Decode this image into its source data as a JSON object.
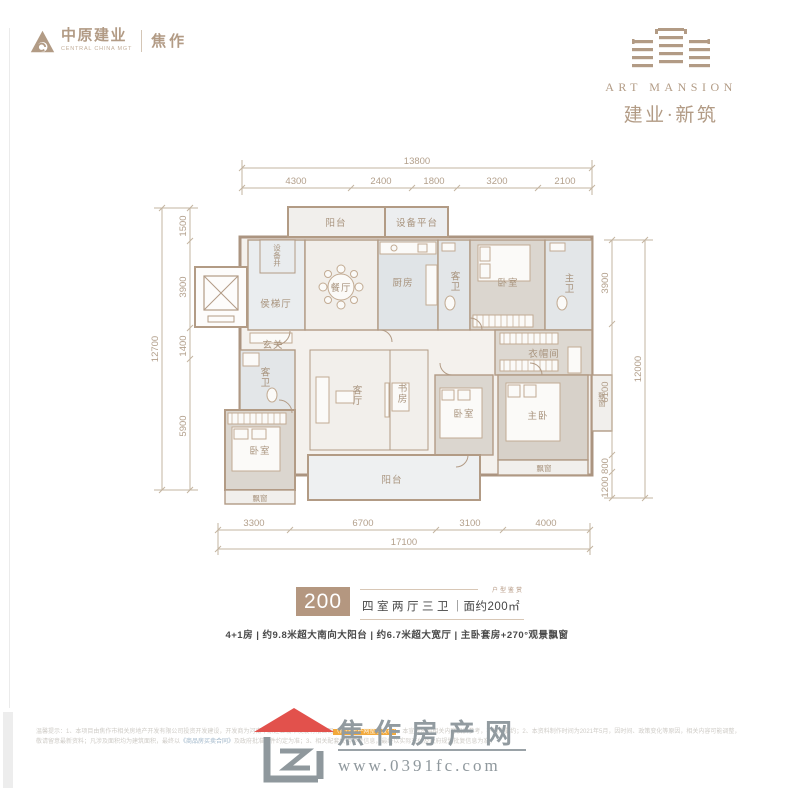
{
  "header": {
    "brand_cn": "中原建业",
    "brand_en": "CENTRAL CHINA MGT",
    "city": "焦作",
    "project_en": "ART MANSION",
    "project_cn": "建业·新筑"
  },
  "floorplan": {
    "dims_top": {
      "total": "13800",
      "segments": [
        "4300",
        "2400",
        "1800",
        "3200",
        "2100"
      ]
    },
    "dims_left": {
      "total": "12700",
      "segments": [
        "1500",
        "3900",
        "1400",
        "5900"
      ]
    },
    "dims_right": {
      "total": "12000",
      "segments": [
        "3900",
        "6100",
        "800",
        "1200"
      ]
    },
    "dims_bottom": {
      "total": "17100",
      "segments": [
        "3300",
        "6700",
        "3100",
        "4000"
      ]
    },
    "rooms": {
      "balcony_top": "阳台",
      "equipment_platform": "设备平台",
      "equipment_shaft": "设备井",
      "elevator_hall": "侯梯厅",
      "dining": "餐厅",
      "kitchen": "厨房",
      "guest_bath_top": "客卫",
      "bedroom_top": "卧室",
      "master_bath": "主卫",
      "foyer": "玄关",
      "cloakroom": "衣帽间",
      "guest_bath_left": "客卫",
      "bedroom_left": "卧室",
      "living": "客厅",
      "study": "书房",
      "bedroom_mid": "卧室",
      "master_bedroom": "主卧",
      "balcony_bottom": "阳台",
      "bay_left": "飘窗",
      "bay_right": "飘窗",
      "bay_side": "飘窗"
    }
  },
  "summary": {
    "area_badge": "200",
    "spec": "四室两厅三卫",
    "divider": "｜",
    "area_text": "面约200㎡",
    "small_caption": "户型鉴赏",
    "features": "4+1房 | 约9.8米超大南向大阳台 | 约6.7米超大宽厅 | 主卧套房+270°观景飘窗"
  },
  "footer": {
    "site_name": "焦作房产网",
    "site_url": "www.0391fc.com",
    "disclaimer": {
      "l1a": "温馨提示：1、本项目由焦作市相关房地产开发有限公司投资开发建设，开发商为河南中原建业城市发展有限公司",
      "l1b": "（焦作房产网整理发布）",
      "l1c": "，本宣传资料相关内容仅供参考，不构成要约；2、本资料制作时",
      "l2a": "间为2021年5月，因时间、政策变化等原因，相关内容可能调整，敬请留意最新资料；凡涉及面积均为建筑面积，最终以",
      "l2b": "《商品房买卖合同》",
      "l2c": "及政府批准文件约定为准；3、相关配套仅供参",
      "l3": "考信息，最终以实际交付及政府规划批复信息为准。"
    }
  },
  "colors": {
    "brand_tan": "#b29b85",
    "badge_bg": "#b49780",
    "footer_gray": "#929ba0",
    "roof_red": "#e2514c",
    "highlight_orange": "#f2a93b"
  }
}
